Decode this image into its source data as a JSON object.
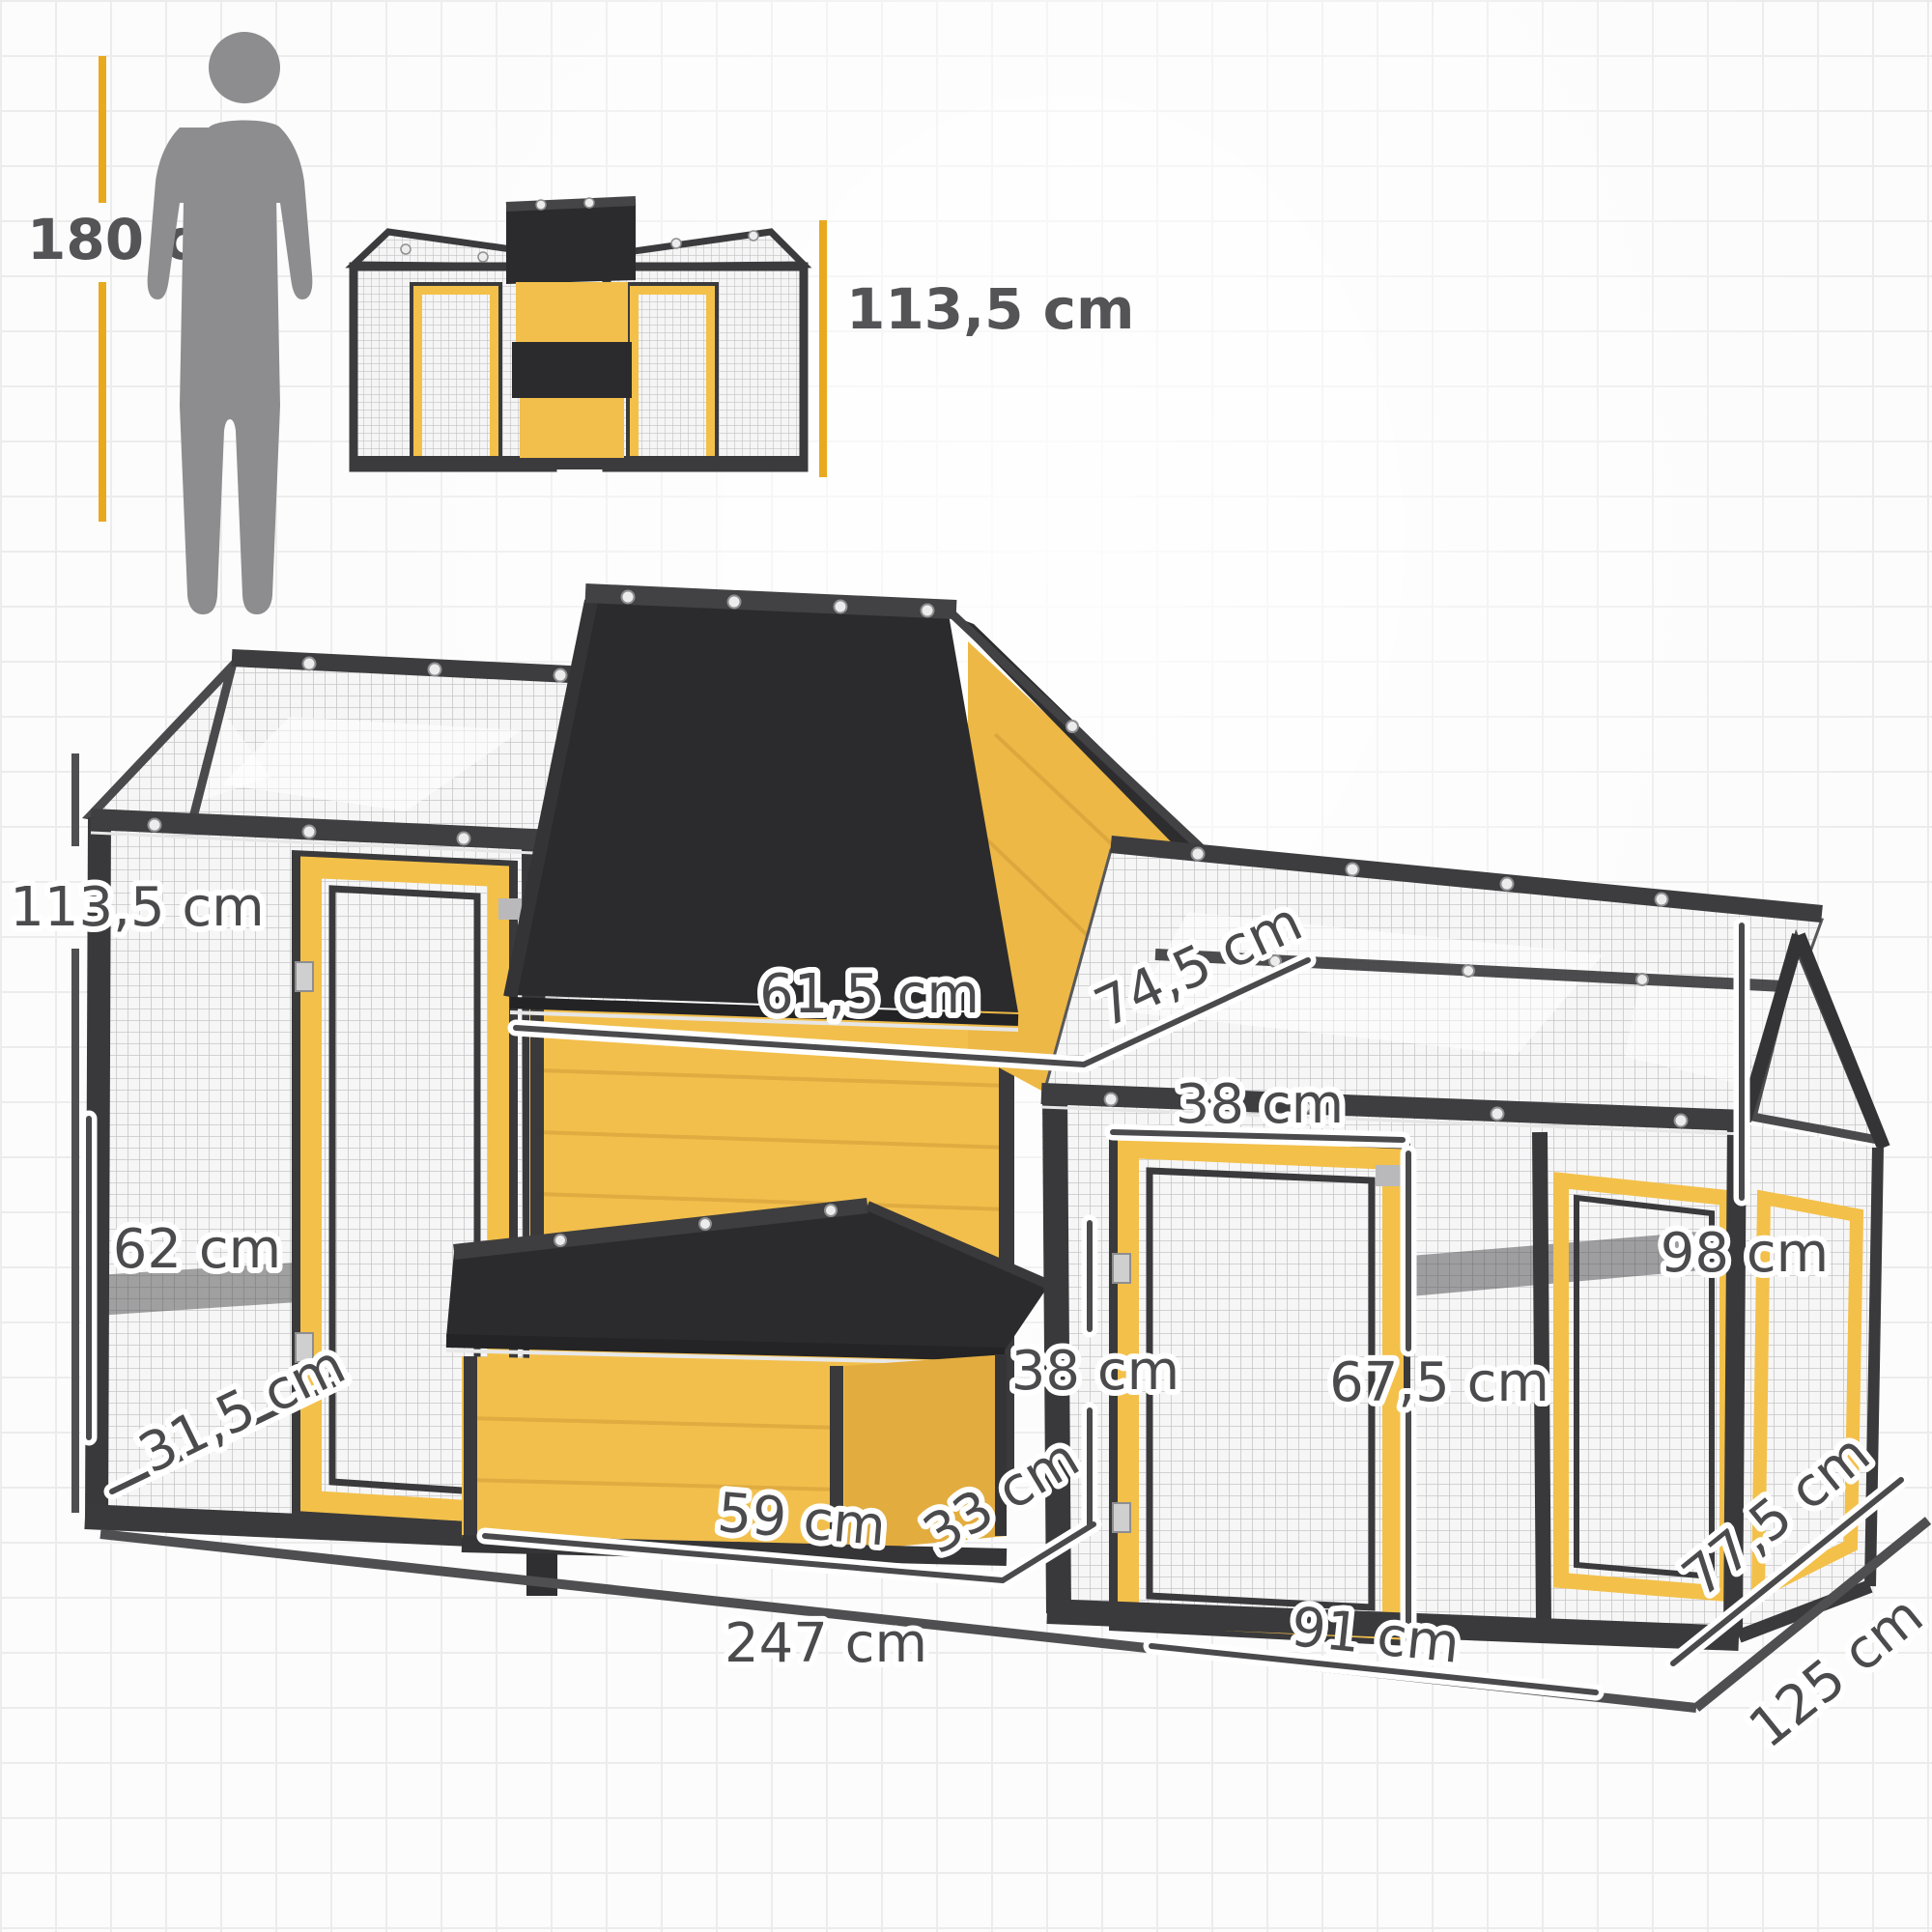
{
  "page": {
    "type": "product-dimension-diagram",
    "unit": "cm",
    "grid_color": "#ececec"
  },
  "scale_reference": {
    "human": {
      "label": "180 cm",
      "icon": "human-silhouette"
    },
    "thumbnail": {
      "label": "113,5 cm",
      "icon": "coop-front-view"
    }
  },
  "main_view": {
    "labels": {
      "total_height": "113,5 cm",
      "left_panel_height": "62 cm",
      "left_panel_depth": "31,5 cm",
      "coop_roof_width": "61,5 cm",
      "coop_roof_depth": "74,5 cm",
      "gable_panel_width": "38 cm",
      "nest_box_height": "38 cm",
      "run_door_height": "67,5 cm",
      "run_wall_height": "98 cm",
      "nest_box_width": "59 cm",
      "nest_box_depth": "33 cm",
      "run_door_width": "91 cm",
      "run_side_depth": "77,5 cm",
      "total_depth": "125 cm",
      "total_width": "247 cm"
    },
    "colors": {
      "wood_yellow": "#f2bf4c",
      "wood_yellow_shade": "#e3ac3e",
      "frame_dark": "#3a3a3c",
      "roof_black": "#2b2b2d",
      "mesh_line": "#c6c6c8",
      "dimension_line": "#4a4a4c",
      "accent_yellow_line": "#e9a91f",
      "silhouette_gray": "#8d8d8f"
    }
  }
}
